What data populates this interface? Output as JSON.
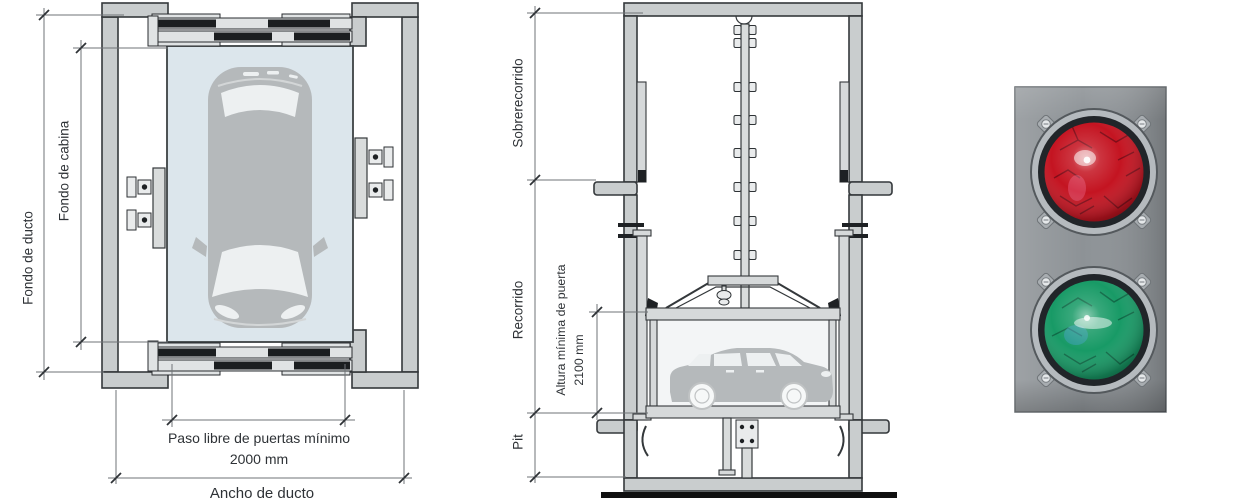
{
  "page": {
    "background": "#ffffff",
    "description": "Car elevator shaft technical drawings (plan view and vertical section) with photo of red/green traffic signal"
  },
  "plan_view": {
    "title": "plan view of car lift shaft",
    "labels": {
      "shaft_depth": "Fondo de ducto",
      "cabin_depth": "Fondo de cabina",
      "door_clear_width_line1": "Paso libre de puertas mínimo",
      "door_clear_width_line2": "2000 mm",
      "shaft_width": "Ancho de ducto"
    }
  },
  "section_view": {
    "title": "vertical section of car lift shaft",
    "labels": {
      "overtravel": "Sobrerecorrido",
      "travel": "Recorrido",
      "pit": "Pit",
      "min_door_height_line1": "Altura mínima de puerta",
      "min_door_height_line2": "2100 mm"
    }
  },
  "traffic_light": {
    "panel_color": "#8d9296",
    "lights": [
      {
        "id": "red-light",
        "lens_color": "#c41421",
        "state": "lit"
      },
      {
        "id": "green-light",
        "lens_color": "#189a66",
        "state": "lit"
      }
    ]
  }
}
